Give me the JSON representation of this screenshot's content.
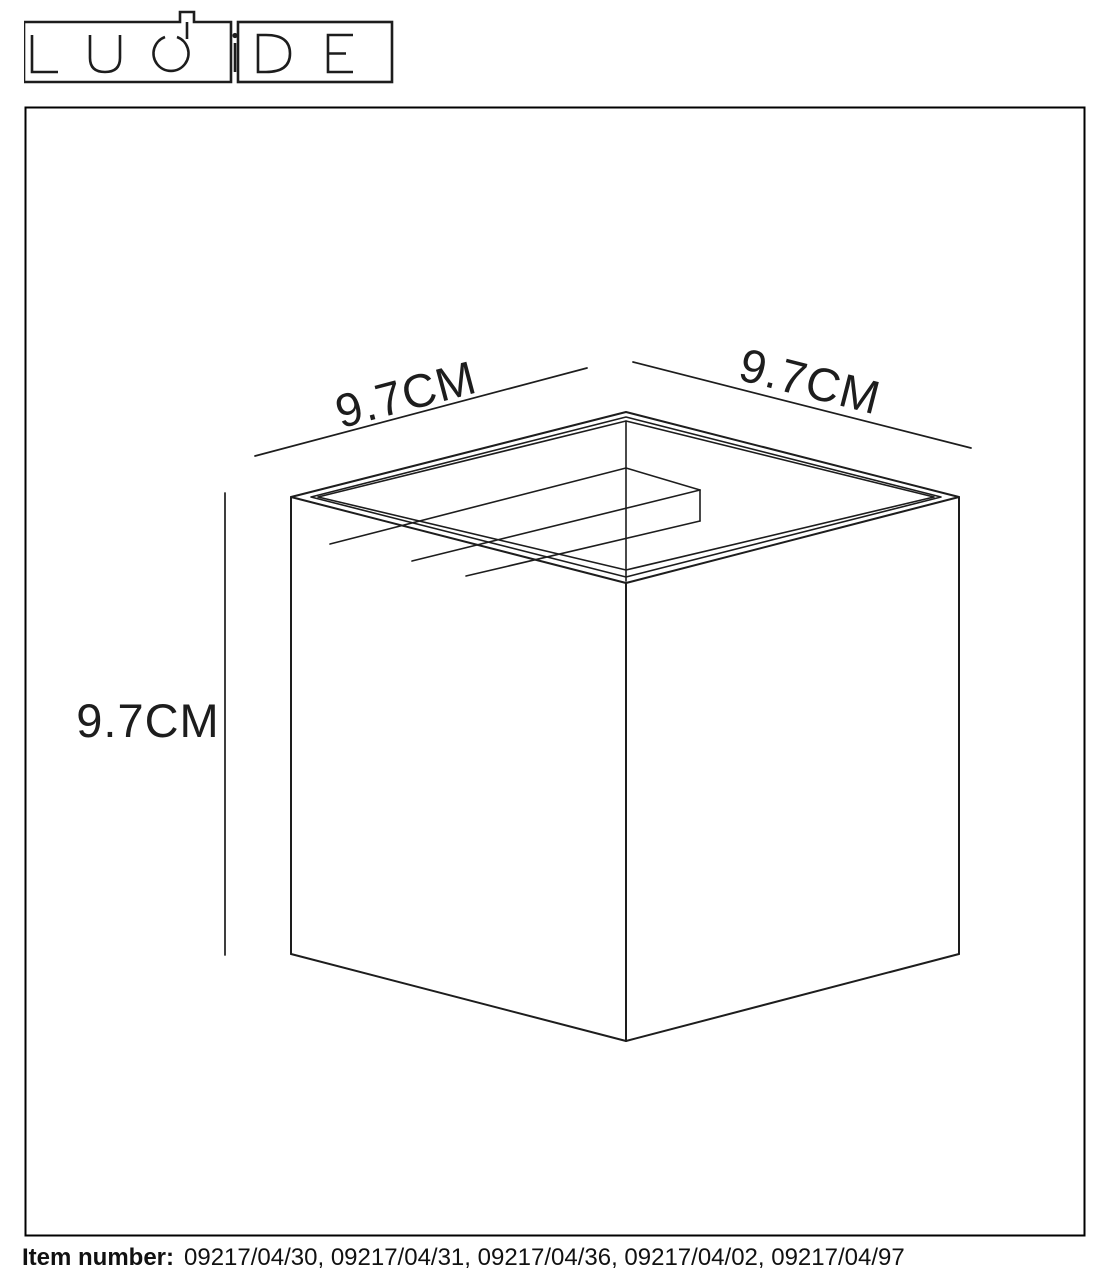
{
  "page": {
    "background": "#ffffff",
    "line_color": "#1d1d1d"
  },
  "logo": {
    "text": "LUCiDE"
  },
  "drawing": {
    "dim_top_left": "9.7CM",
    "dim_top_right": "9.7CM",
    "dim_left": "9.7CM"
  },
  "footer": {
    "label": "Item number:",
    "numbers": "09217/04/30, 09217/04/31, 09217/04/36, 09217/04/02, 09217/04/97"
  }
}
